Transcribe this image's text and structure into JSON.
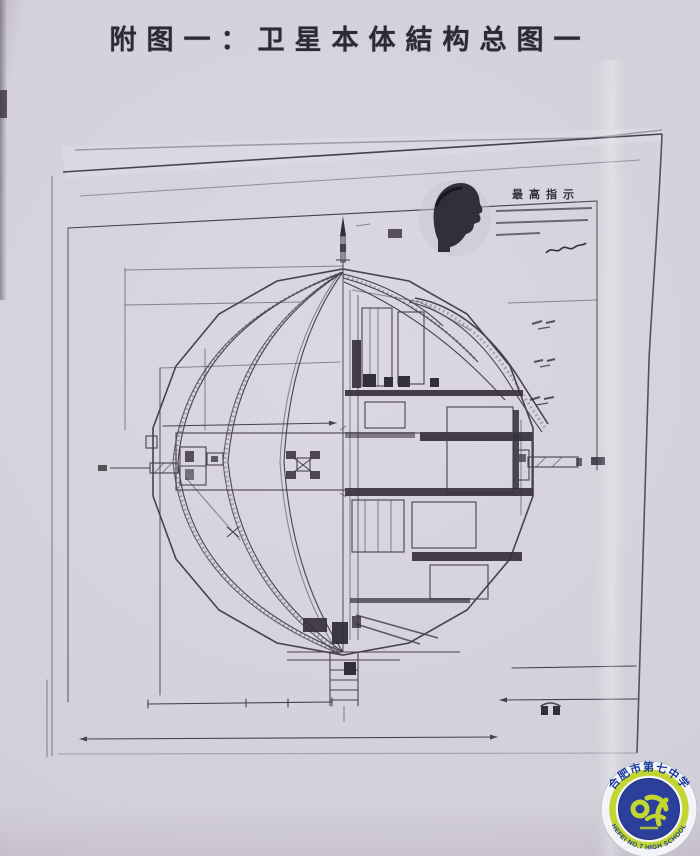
{
  "page": {
    "title": "附图一：卫星本体結构总图一"
  },
  "quote_block": {
    "heading": "最高指示"
  },
  "badge": {
    "school_name_cn": "合肥市第七中学",
    "school_name_en": "HEFEI NO.7 HIGH SCHOOL"
  },
  "colors": {
    "paper": "#d3cfd9",
    "sheet": "#dbd8e1",
    "ink": "#46424e",
    "ink_dark": "#332f3a",
    "line_soft": "#8f8b98",
    "title_ink": "#2d2935",
    "badge_blue": "#2b3f9b",
    "badge_blue_dark": "#1e2f7d",
    "badge_green": "#c2d531",
    "badge_text_blue": "#1c3a9c",
    "badge_ring_bg": "#f2f4f7"
  }
}
